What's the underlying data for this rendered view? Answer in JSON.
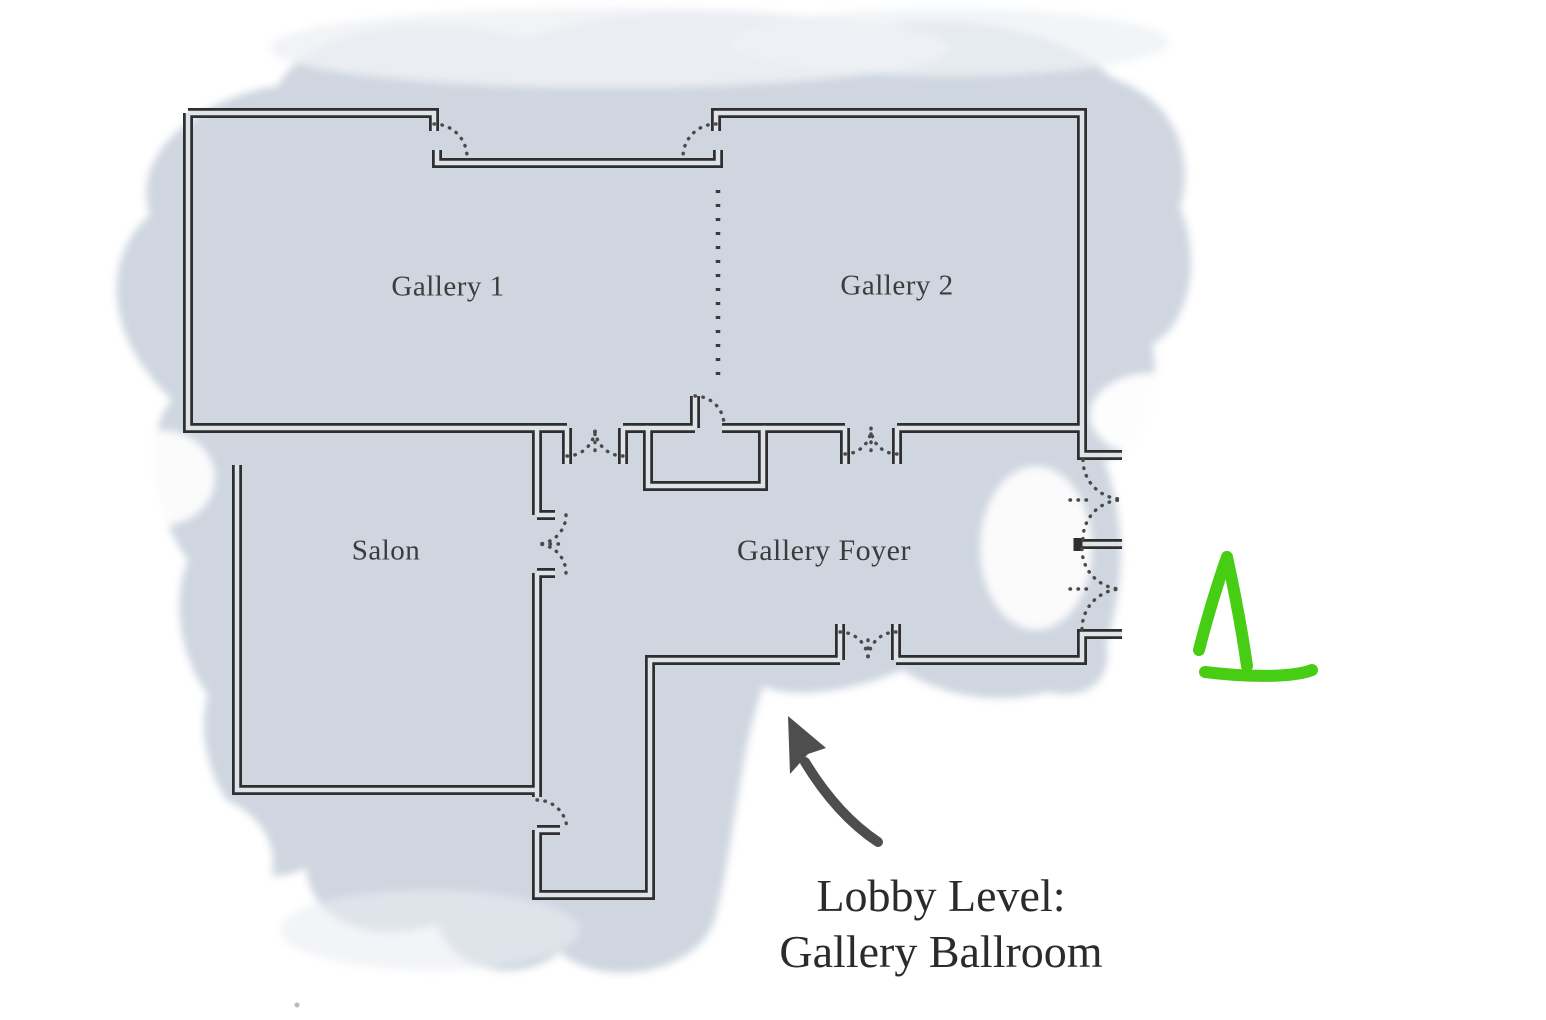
{
  "rooms": {
    "gallery1": "Gallery 1",
    "gallery2": "Gallery 2",
    "salon": "Salon",
    "foyer": "Gallery Foyer"
  },
  "caption": {
    "line1": "Lobby Level:",
    "line2": "Gallery Ballroom"
  },
  "colors": {
    "wall": "#2f2f2f",
    "wall_cavity": "#dfe3ea",
    "floor_wash": "#cfd6e0",
    "door_arc": "#4a4a4a",
    "label_text": "#3c3c3c",
    "caption_text": "#2b2b2b",
    "arrow": "#4e4e4e",
    "marker_green": "#47cd14"
  }
}
